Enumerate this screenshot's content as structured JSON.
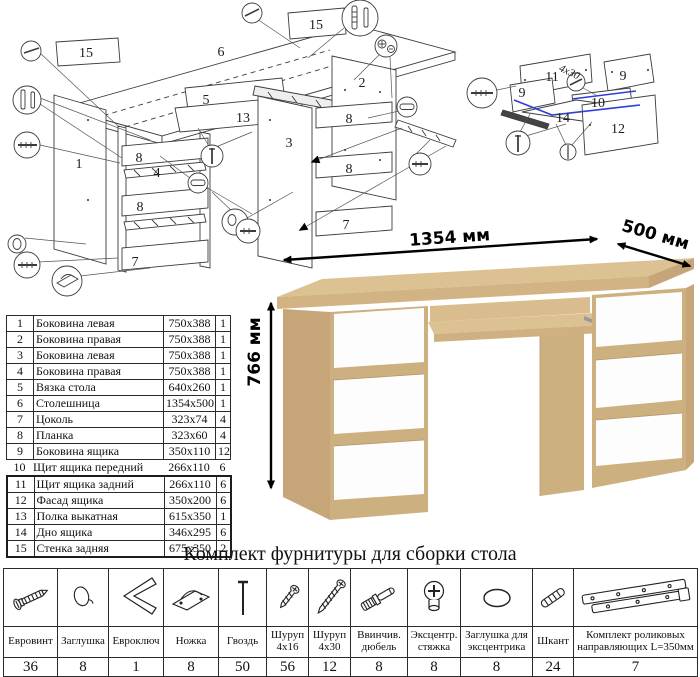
{
  "diagram_main": {
    "labels": [
      "15",
      "6",
      "15",
      "2",
      "5",
      "13",
      "3",
      "1",
      "8",
      "4",
      "8",
      "7",
      "8",
      "8",
      "7"
    ]
  },
  "diagram_drawer": {
    "labels": [
      "11",
      "9",
      "9",
      "10",
      "14",
      "12"
    ],
    "annotation": "4x30",
    "highlight_color": "#2d3fd4"
  },
  "dimensions": {
    "width": "1354 мм",
    "depth": "500 мм",
    "height": "766 мм"
  },
  "parts_table": {
    "rows": [
      {
        "num": "1",
        "name": "Боковина левая",
        "size": "750x388",
        "qty": "1"
      },
      {
        "num": "2",
        "name": "Боковина правая",
        "size": "750x388",
        "qty": "1"
      },
      {
        "num": "3",
        "name": "Боковина левая",
        "size": "750x388",
        "qty": "1"
      },
      {
        "num": "4",
        "name": "Боковина правая",
        "size": "750x388",
        "qty": "1"
      },
      {
        "num": "5",
        "name": "Вязка стола",
        "size": "640x260",
        "qty": "1"
      },
      {
        "num": "6",
        "name": "Столешница",
        "size": "1354x500",
        "qty": "1"
      },
      {
        "num": "7",
        "name": "Цоколь",
        "size": "323x74",
        "qty": "4"
      },
      {
        "num": "8",
        "name": "Планка",
        "size": "323x60",
        "qty": "4"
      },
      {
        "num": "9",
        "name": "Боковина ящика",
        "size": "350x110",
        "qty": "12"
      },
      {
        "num": "10",
        "name": "Щит ящика передний",
        "size": "266x110",
        "qty": "6"
      },
      {
        "num": "11",
        "name": "Щит ящика задний",
        "size": "266x110",
        "qty": "6"
      },
      {
        "num": "12",
        "name": "Фасад ящика",
        "size": "350x200",
        "qty": "6"
      },
      {
        "num": "13",
        "name": "Полка выкатная",
        "size": "615x350",
        "qty": "1"
      },
      {
        "num": "14",
        "name": "Дно ящика",
        "size": "346x295",
        "qty": "6"
      },
      {
        "num": "15",
        "name": "Стенка задняя",
        "size": "675x350",
        "qty": "2"
      }
    ]
  },
  "hardware": {
    "title": "Комплект фурнитуры для сборки стола",
    "items": [
      {
        "name": "Евровинт",
        "qty": "36",
        "icon": "euro-screw-icon"
      },
      {
        "name": "Заглушка",
        "qty": "8",
        "icon": "cap-icon"
      },
      {
        "name": "Евроключ",
        "qty": "1",
        "icon": "hex-key-icon"
      },
      {
        "name": "Ножка",
        "qty": "8",
        "icon": "foot-icon"
      },
      {
        "name": "Гвоздь",
        "qty": "50",
        "icon": "nail-icon"
      },
      {
        "name": "Шуруп 4x16",
        "qty": "56",
        "icon": "screw-short-icon"
      },
      {
        "name": "Шуруп 4x30",
        "qty": "12",
        "icon": "screw-long-icon"
      },
      {
        "name": "Ввинчив. дюбель",
        "qty": "8",
        "icon": "threaded-dowel-icon"
      },
      {
        "name": "Эксцентр. стяжка",
        "qty": "8",
        "icon": "cam-lock-icon"
      },
      {
        "name": "Заглушка для эксцентрика",
        "qty": "8",
        "icon": "cam-cap-icon"
      },
      {
        "name": "Шкант",
        "qty": "24",
        "icon": "wood-dowel-icon"
      },
      {
        "name": "Комплект роликовых направляющих L=350мм",
        "qty": "7",
        "icon": "drawer-slide-icon"
      }
    ]
  },
  "desk": {
    "colors": {
      "wood_top": "#dcc193",
      "wood_front": "#d2b384",
      "wood_side": "#c6a678",
      "wood_strip": "#cdb07f",
      "drawer_white": "#fdfdfd"
    }
  }
}
